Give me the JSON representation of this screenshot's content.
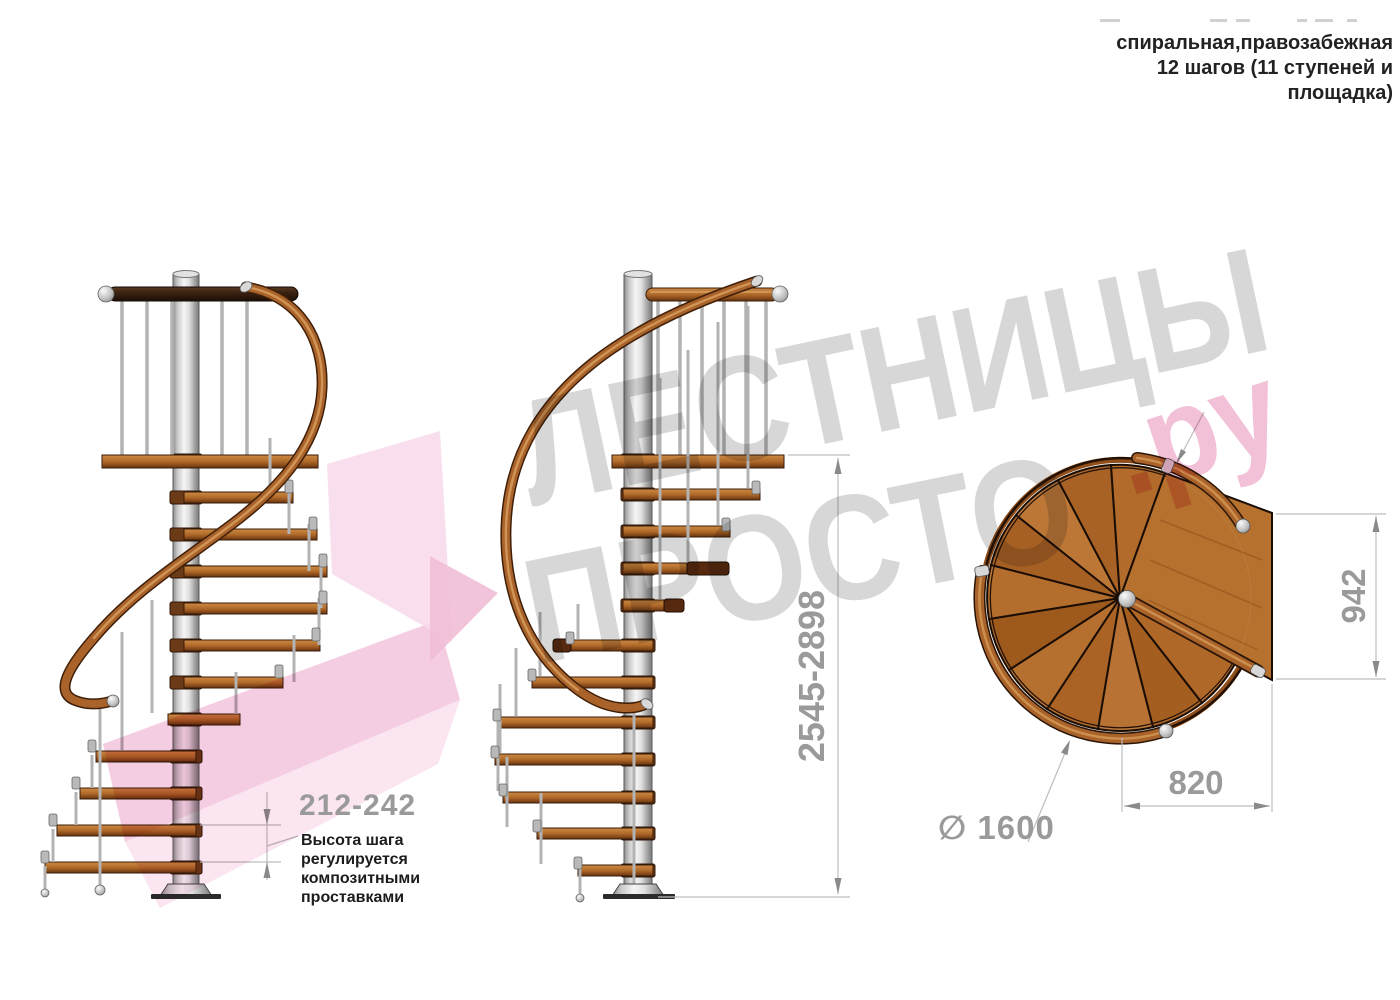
{
  "header": {
    "lines": [
      "спиральная,правозабежная",
      "12 шагов (11 ступеней и",
      "площадка)"
    ]
  },
  "watermark": {
    "word1": "ЛЕСТНИЦЫ",
    "word2": "ПРОСТО",
    "suffix": ".ру"
  },
  "dimensions": {
    "step_height": "212-242",
    "step_height_note": [
      "Высота шага",
      "регулируется",
      "композитными",
      "проставками"
    ],
    "total_height": "2545-2898",
    "landing_depth": "942",
    "landing_width": "820",
    "diameter": "∅ 1600"
  },
  "colors": {
    "dimension_text": "#9a9a9a",
    "note_text": "#1c1c1c",
    "watermark_gray": "#d7d7d7",
    "watermark_pink": "#f3c1d7",
    "wood": "#a8622a",
    "dark_wood": "#3a2212",
    "metal": "#c9c9c9"
  }
}
